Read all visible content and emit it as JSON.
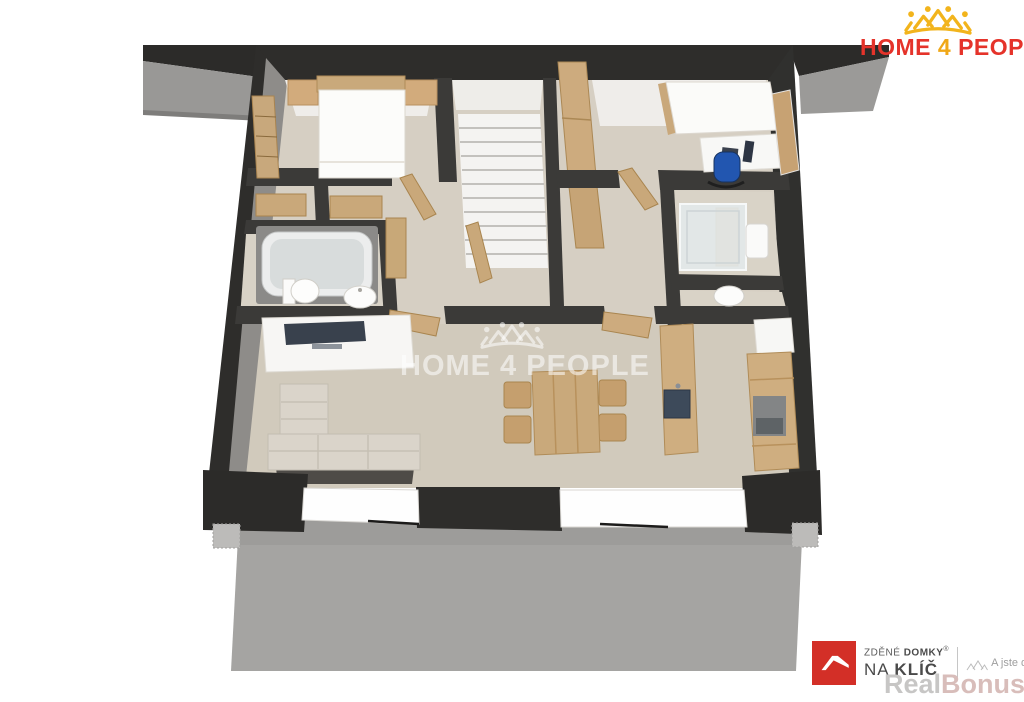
{
  "header_logo": {
    "icon": "home4people-crown-icon",
    "word1": "HOME",
    "word2": "4",
    "word3": "PEOPLE"
  },
  "watermark_center": {
    "icon": "home4people-crown-icon",
    "text": "HOME 4 PEOPLE"
  },
  "footer_logo": {
    "icon": "roof-logo-icon",
    "line1_light": "ZDĚNÉ",
    "line1_bold": "DOMKY",
    "registered_mark": "®",
    "line2_light": "NA",
    "line2_bold": "KLÍČ",
    "tagline_icon": "houses-sketch-icon",
    "tagline": "A jste doma."
  },
  "site_watermark": {
    "part1": "Real",
    "part2": "Bonus",
    "part3": ".cz"
  },
  "floor_plan": {
    "view": "3d-top-down-render",
    "rooms": [
      "bedroom",
      "staircase",
      "wardrobe-closets",
      "bathroom",
      "hallway",
      "office-bedroom",
      "shower-room",
      "wc",
      "living-room",
      "dining-area",
      "kitchen"
    ],
    "outdoor": [
      "terrace",
      "ledge-left",
      "ledge-right"
    ],
    "furniture": [
      "double-bed",
      "nightstands",
      "wardrobe",
      "stairs",
      "bathtub",
      "toilet",
      "washbasin",
      "single-bed",
      "desk",
      "office-chair",
      "monitor",
      "shower-cabin",
      "tv-sideboard",
      "tv",
      "corner-sofa",
      "dining-table",
      "dining-chairs",
      "kitchen-island-with-sink",
      "kitchen-counter",
      "oven"
    ]
  },
  "colors": {
    "wall": "#2e2d2b",
    "floor": "#d5cec2",
    "terrace": "#a5a4a2",
    "wood": "#c9a87b",
    "brand_red": "#e5332a",
    "brand_gold": "#f2b41c"
  }
}
